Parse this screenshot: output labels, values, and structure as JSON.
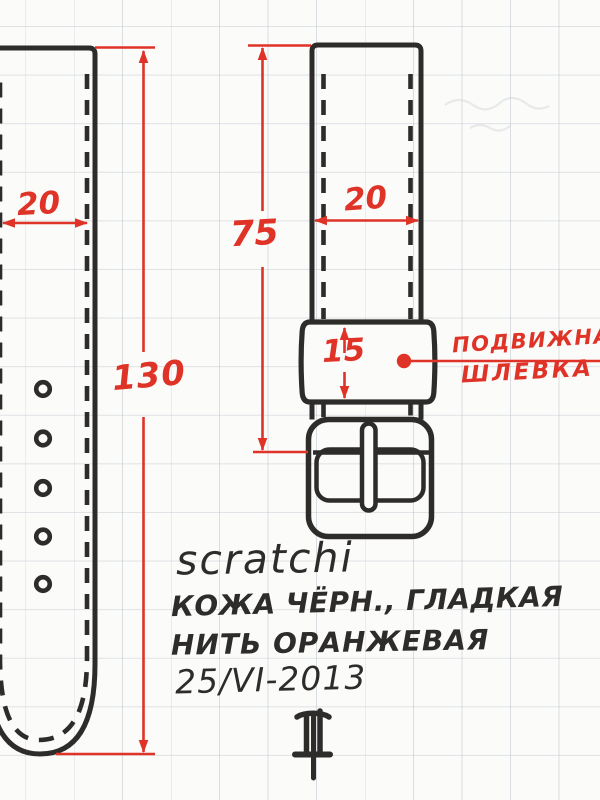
{
  "drawing": {
    "dimensions": {
      "left_strap_width": "20",
      "left_strap_length": "130",
      "right_strap_length": "75",
      "right_strap_width": "20",
      "keeper_height": "15"
    },
    "callout": {
      "line1": "ПОДВИЖНАЯ",
      "line2": "ШЛЕВКА"
    },
    "notes": {
      "brand": "scratchi",
      "material": "КОЖА ЧЁРН., ГЛАДКАЯ",
      "thread": "НИТЬ ОРАНЖЕВАЯ",
      "date": "25/VI-2013"
    },
    "colors": {
      "ink": "#2e2c2a",
      "dimension_red": "#e03328",
      "paper": "#fbfbf9",
      "grid": "#b7c0c9"
    }
  }
}
